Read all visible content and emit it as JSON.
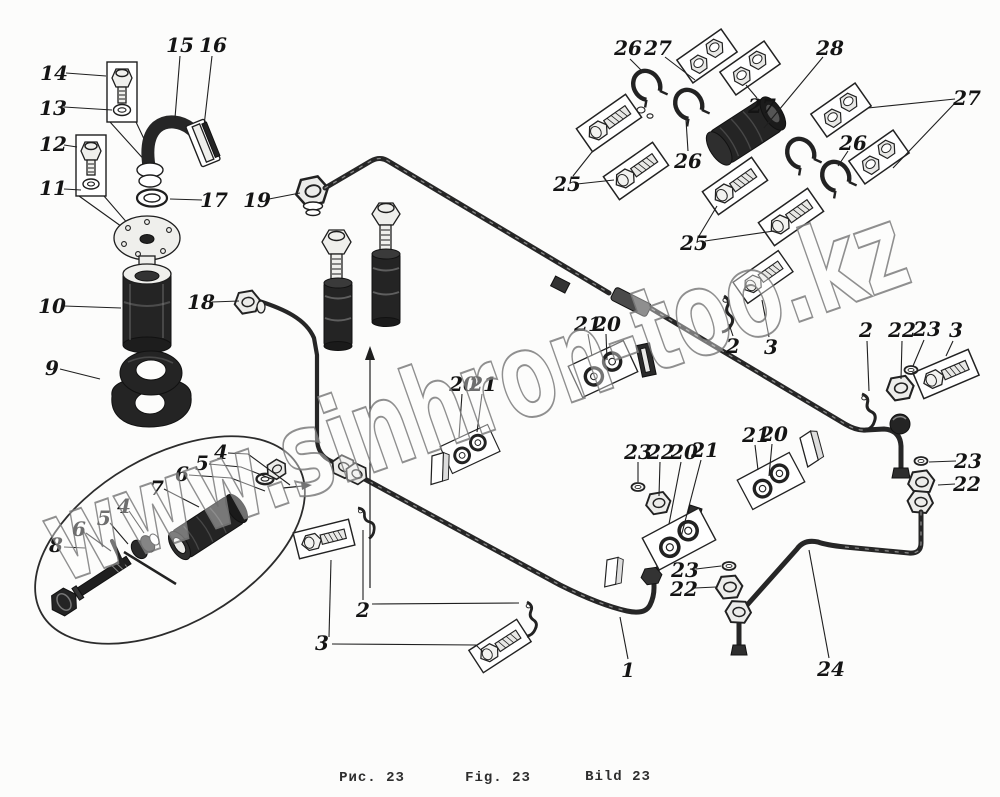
{
  "figure": {
    "number": "23",
    "captions": {
      "ru": "Рис. 23",
      "en": "Fig. 23",
      "de": "Bild 23"
    }
  },
  "watermark": {
    "text": "www.sinhron-too.kz"
  },
  "colors": {
    "ink": "#1e1e1e",
    "paper": "#fcfcfb",
    "dark_part": "#242424",
    "watermark_stroke": "#7d7d7d"
  },
  "callouts": [
    {
      "label": "14",
      "x": 54,
      "y": 73,
      "leaders": [
        [
          [
            66,
            73
          ],
          [
            106,
            76
          ]
        ]
      ]
    },
    {
      "label": "13",
      "x": 53,
      "y": 108,
      "leaders": [
        [
          [
            64,
            107
          ],
          [
            112,
            110
          ]
        ]
      ]
    },
    {
      "label": "12",
      "x": 53,
      "y": 144,
      "leaders": [
        [
          [
            64,
            145
          ],
          [
            77,
            147
          ]
        ]
      ]
    },
    {
      "label": "11",
      "x": 53,
      "y": 188,
      "leaders": [
        [
          [
            64,
            189
          ],
          [
            81,
            190
          ]
        ]
      ]
    },
    {
      "label": "15",
      "x": 180,
      "y": 45,
      "leaders": [
        [
          [
            180,
            56
          ],
          [
            175,
            118
          ]
        ]
      ]
    },
    {
      "label": "16",
      "x": 213,
      "y": 45,
      "leaders": [
        [
          [
            212,
            56
          ],
          [
            204,
            126
          ]
        ]
      ]
    },
    {
      "label": "17",
      "x": 214,
      "y": 200,
      "leaders": [
        [
          [
            202,
            200
          ],
          [
            170,
            199
          ]
        ]
      ]
    },
    {
      "label": "19",
      "x": 257,
      "y": 200,
      "leaders": [
        [
          [
            269,
            199
          ],
          [
            300,
            193
          ]
        ]
      ]
    },
    {
      "label": "10",
      "x": 52,
      "y": 306,
      "leaders": [
        [
          [
            64,
            306
          ],
          [
            121,
            308
          ]
        ]
      ]
    },
    {
      "label": "9",
      "x": 52,
      "y": 368,
      "leaders": [
        [
          [
            60,
            369
          ],
          [
            100,
            379
          ]
        ]
      ]
    },
    {
      "label": "18",
      "x": 201,
      "y": 302,
      "leaders": [
        [
          [
            212,
            302
          ],
          [
            239,
            301
          ]
        ]
      ]
    },
    {
      "label": "4",
      "x": 221,
      "y": 452,
      "leaders": [
        [
          [
            228,
            453
          ],
          [
            248,
            454
          ],
          [
            290,
            485
          ]
        ]
      ]
    },
    {
      "label": "5",
      "x": 202,
      "y": 463,
      "leaders": [
        [
          [
            209,
            464
          ],
          [
            241,
            467
          ],
          [
            272,
            479
          ]
        ]
      ]
    },
    {
      "label": "6",
      "x": 182,
      "y": 474,
      "leaders": [
        [
          [
            189,
            475
          ],
          [
            231,
            478
          ],
          [
            265,
            491
          ]
        ]
      ]
    },
    {
      "label": "7",
      "x": 157,
      "y": 488,
      "leaders": [
        [
          [
            164,
            489
          ],
          [
            199,
            507
          ]
        ]
      ]
    },
    {
      "label": "4",
      "x": 124,
      "y": 506,
      "leaders": [
        [
          [
            129,
            511
          ],
          [
            144,
            533
          ]
        ]
      ]
    },
    {
      "label": "5",
      "x": 104,
      "y": 518,
      "leaders": [
        [
          [
            110,
            523
          ],
          [
            128,
            544
          ]
        ]
      ]
    },
    {
      "label": "6",
      "x": 79,
      "y": 529,
      "leaders": [
        [
          [
            86,
            533
          ],
          [
            111,
            551
          ]
        ]
      ]
    },
    {
      "label": "8",
      "x": 56,
      "y": 545,
      "leaders": [
        [
          [
            64,
            547
          ],
          [
            85,
            548
          ]
        ]
      ]
    },
    {
      "label": "2",
      "x": 363,
      "y": 610,
      "leaders": [
        [
          [
            363,
            600
          ],
          [
            363,
            530
          ]
        ],
        [
          [
            372,
            604
          ],
          [
            519,
            603
          ]
        ]
      ]
    },
    {
      "label": "3",
      "x": 322,
      "y": 643,
      "leaders": [
        [
          [
            329,
            637
          ],
          [
            331,
            560
          ]
        ],
        [
          [
            332,
            644
          ],
          [
            476,
            645
          ],
          [
            483,
            652
          ]
        ]
      ]
    },
    {
      "label": "1",
      "x": 628,
      "y": 670,
      "leaders": [
        [
          [
            628,
            659
          ],
          [
            620,
            617
          ]
        ]
      ]
    },
    {
      "label": "24",
      "x": 831,
      "y": 669,
      "leaders": [
        [
          [
            829,
            658
          ],
          [
            809,
            550
          ]
        ]
      ]
    },
    {
      "label": "20",
      "x": 463,
      "y": 384,
      "leaders": [
        [
          [
            462,
            394
          ],
          [
            459,
            437
          ]
        ]
      ]
    },
    {
      "label": "21",
      "x": 483,
      "y": 384,
      "leaders": [
        [
          [
            482,
            394
          ],
          [
            477,
            432
          ]
        ]
      ]
    },
    {
      "label": "21",
      "x": 588,
      "y": 324,
      "leaders": [
        [
          [
            588,
            334
          ],
          [
            592,
            356
          ]
        ]
      ]
    },
    {
      "label": "20",
      "x": 607,
      "y": 324,
      "leaders": [
        [
          [
            606,
            334
          ],
          [
            607,
            360
          ]
        ]
      ]
    },
    {
      "label": "2",
      "x": 733,
      "y": 346,
      "leaders": [
        [
          [
            733,
            336
          ],
          [
            729,
            324
          ]
        ]
      ]
    },
    {
      "label": "3",
      "x": 771,
      "y": 347,
      "leaders": [
        [
          [
            769,
            337
          ],
          [
            762,
            300
          ]
        ]
      ]
    },
    {
      "label": "25",
      "x": 567,
      "y": 184,
      "leaders": [
        [
          [
            573,
            176
          ],
          [
            592,
            152
          ]
        ],
        [
          [
            577,
            184
          ],
          [
            614,
            180
          ]
        ]
      ]
    },
    {
      "label": "25",
      "x": 694,
      "y": 243,
      "leaders": [
        [
          [
            699,
            236
          ],
          [
            717,
            206
          ]
        ],
        [
          [
            705,
            241
          ],
          [
            774,
            231
          ]
        ]
      ]
    },
    {
      "label": "26",
      "x": 628,
      "y": 48,
      "leaders": [
        [
          [
            630,
            59
          ],
          [
            641,
            70
          ]
        ]
      ]
    },
    {
      "label": "27",
      "x": 658,
      "y": 48,
      "leaders": [
        [
          [
            665,
            57
          ],
          [
            695,
            80
          ]
        ]
      ]
    },
    {
      "label": "27",
      "x": 762,
      "y": 106,
      "leaders": [
        [
          [
            757,
            98
          ],
          [
            746,
            85
          ]
        ]
      ]
    },
    {
      "label": "28",
      "x": 830,
      "y": 48,
      "leaders": [
        [
          [
            823,
            57
          ],
          [
            764,
            128
          ]
        ]
      ]
    },
    {
      "label": "26",
      "x": 688,
      "y": 161,
      "leaders": [
        [
          [
            688,
            151
          ],
          [
            686,
            120
          ]
        ]
      ]
    },
    {
      "label": "26",
      "x": 853,
      "y": 143,
      "leaders": [
        [
          [
            848,
            151
          ],
          [
            838,
            166
          ]
        ]
      ]
    },
    {
      "label": "27",
      "x": 967,
      "y": 98,
      "leaders": [
        [
          [
            955,
            99
          ],
          [
            868,
            108
          ]
        ],
        [
          [
            955,
            103
          ],
          [
            893,
            168
          ]
        ]
      ]
    },
    {
      "label": "2",
      "x": 866,
      "y": 330,
      "leaders": [
        [
          [
            867,
            341
          ],
          [
            869,
            391
          ]
        ]
      ]
    },
    {
      "label": "22",
      "x": 902,
      "y": 330,
      "leaders": [
        [
          [
            902,
            341
          ],
          [
            901,
            379
          ]
        ]
      ]
    },
    {
      "label": "23",
      "x": 927,
      "y": 329,
      "leaders": [
        [
          [
            924,
            340
          ],
          [
            913,
            366
          ]
        ]
      ]
    },
    {
      "label": "3",
      "x": 956,
      "y": 330,
      "leaders": [
        [
          [
            953,
            341
          ],
          [
            946,
            356
          ]
        ]
      ]
    },
    {
      "label": "23",
      "x": 968,
      "y": 461,
      "leaders": [
        [
          [
            956,
            461
          ],
          [
            929,
            462
          ]
        ]
      ]
    },
    {
      "label": "22",
      "x": 967,
      "y": 484,
      "leaders": [
        [
          [
            955,
            484
          ],
          [
            938,
            485
          ]
        ]
      ]
    },
    {
      "label": "23",
      "x": 638,
      "y": 452,
      "leaders": [
        [
          [
            638,
            462
          ],
          [
            638,
            482
          ]
        ]
      ]
    },
    {
      "label": "22",
      "x": 661,
      "y": 452,
      "leaders": [
        [
          [
            660,
            462
          ],
          [
            659,
            496
          ]
        ]
      ]
    },
    {
      "label": "20",
      "x": 684,
      "y": 452,
      "leaders": [
        [
          [
            681,
            462
          ],
          [
            669,
            524
          ]
        ]
      ]
    },
    {
      "label": "21",
      "x": 705,
      "y": 450,
      "leaders": [
        [
          [
            701,
            460
          ],
          [
            681,
            537
          ]
        ]
      ]
    },
    {
      "label": "21",
      "x": 756,
      "y": 435,
      "leaders": [
        [
          [
            755,
            445
          ],
          [
            758,
            470
          ]
        ]
      ]
    },
    {
      "label": "20",
      "x": 774,
      "y": 434,
      "leaders": [
        [
          [
            772,
            444
          ],
          [
            769,
            476
          ]
        ]
      ]
    },
    {
      "label": "23",
      "x": 685,
      "y": 570,
      "leaders": [
        [
          [
            696,
            569
          ],
          [
            721,
            566
          ]
        ]
      ]
    },
    {
      "label": "22",
      "x": 684,
      "y": 589,
      "leaders": [
        [
          [
            695,
            588
          ],
          [
            716,
            587
          ]
        ]
      ]
    }
  ]
}
